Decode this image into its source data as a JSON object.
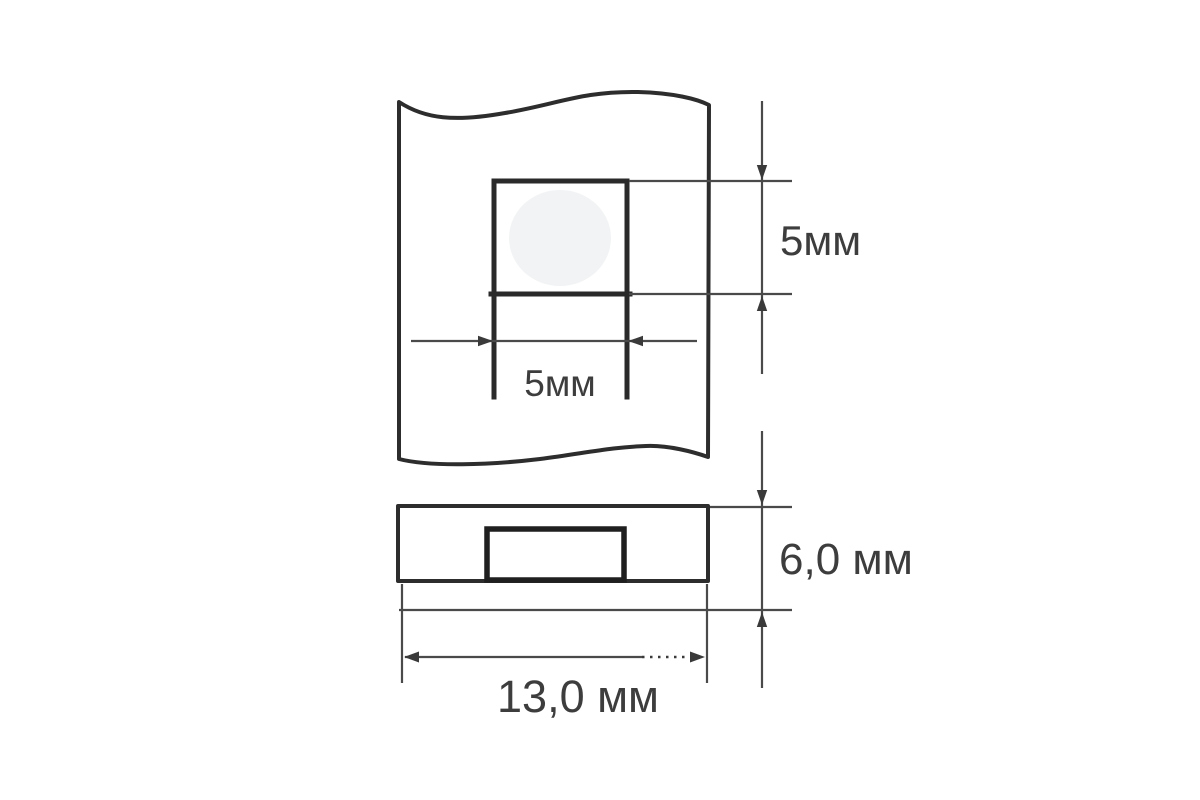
{
  "drawing": {
    "front_view": {
      "pocket_height_label": "5мм",
      "pocket_width_label": "5мм"
    },
    "side_view": {
      "height_label": "6,0 мм",
      "width_label": "13,0 мм"
    }
  },
  "colors": {
    "background": "#ffffff",
    "outline": "#2d2d2d",
    "dimension_line": "#4a4a4a",
    "arrowhead": "#3a3a3a",
    "label_text": "#3d3d3d",
    "circle_fill": "#f2f3f4"
  }
}
